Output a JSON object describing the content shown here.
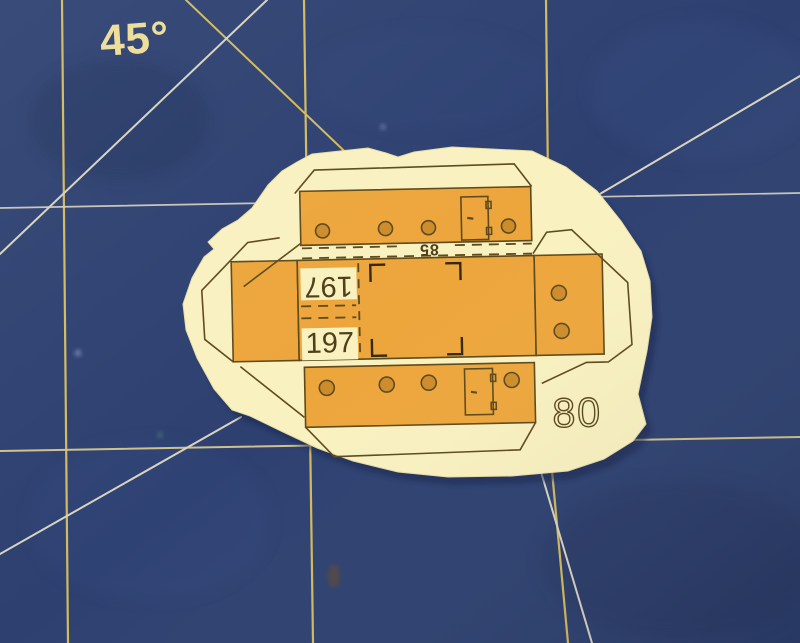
{
  "scene": {
    "type": "photograph",
    "description": "Cut-out paper model part lying on a dark blue self-healing cutting mat with yellow grid lines and 45-degree guide lines",
    "mat": {
      "angle_label": "45°",
      "colors": {
        "base": "#2d4070",
        "grid_line": "#d2ba5e",
        "guide_line": "#d9d3c0"
      }
    },
    "part": {
      "part_number": "80",
      "width_dimension": "85",
      "length_dimension_top": "197",
      "length_dimension_bottom": "197",
      "colors": {
        "paper": "#f9f1c0",
        "print": "#eda63c",
        "holes": "#cd8c2c",
        "lines": "#5d4a1c"
      },
      "features": {
        "top_panel_holes": 4,
        "bottom_panel_holes": 4,
        "right_panel_holes": 2,
        "doors": 2,
        "registration_brackets": 4,
        "glue_tabs": 4
      }
    }
  }
}
